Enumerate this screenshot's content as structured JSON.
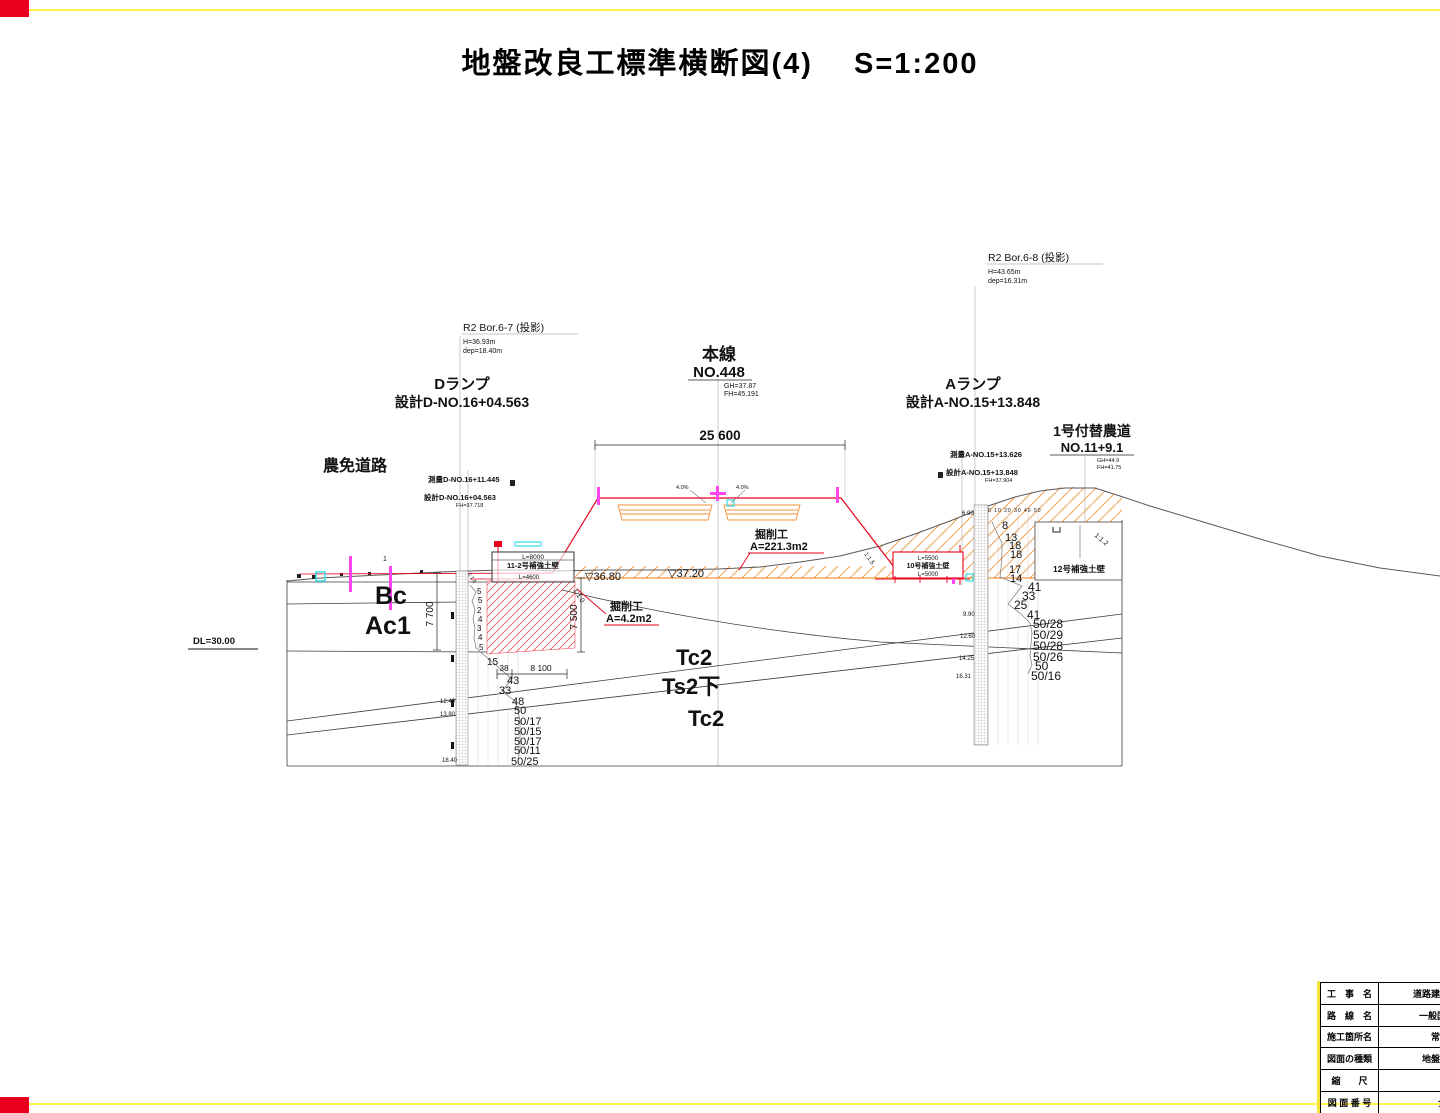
{
  "colors": {
    "frame_yellow": "#fff34d",
    "corner_red": "#e8001e",
    "annotation_red": "#e8001e",
    "hatch_orange": "#f2a359",
    "design_orange": "#f0933a",
    "magenta": "#ff44f0",
    "cyan": "#35dfe6"
  },
  "title": "地盤改良工標準横断図(4)　 S=1:200",
  "datum": "DL=30.00",
  "borings": {
    "b67": {
      "name": "R2 Bor.6-7 (投影)",
      "h": "H=36.93m",
      "dep": "dep=18.40m"
    },
    "b68": {
      "name": "R2 Bor.6-8 (投影)",
      "h": "H=43.65m",
      "dep": "dep=16.31m"
    }
  },
  "axes": {
    "d_ramp": {
      "name": "Dランプ",
      "station": "設計D-NO.16+04.563"
    },
    "main_line": {
      "name": "本線",
      "station": "NO.448",
      "gh": "GH=37.87",
      "fh": "FH=45.191"
    },
    "a_ramp": {
      "name": "Aランプ",
      "station": "設計A-NO.15+13.848"
    },
    "farm_road": {
      "name": "1号付替農道",
      "station": "NO.11+9.1",
      "gh": "GH=44.9",
      "fh": "FH=41.75"
    },
    "nomen": "農免道路",
    "survey_d": "測量D-NO.16+11.445",
    "design_d": "設計D-NO.16+04.563",
    "design_d_fh": "FH=37.718",
    "survey_a": "測量A-NO.15+13.626",
    "design_a": "設計A-NO.15+13.848",
    "design_a_fh": "FH=37.904",
    "pt1": "1"
  },
  "dims": {
    "road_width": "25 600",
    "v_left": "7 700",
    "v_mid": "7 500",
    "w1": "38",
    "w2": "8 100"
  },
  "levels": {
    "l1": "▽36.80",
    "l2": "▽37.20"
  },
  "grades": {
    "left": "4.0%",
    "right": "4.0%"
  },
  "excavation": {
    "big": {
      "t": "掘削工",
      "a": "A=221.3m2"
    },
    "small": {
      "t": "掘削工",
      "a": "A=4.2m2"
    }
  },
  "walls": {
    "w11": {
      "name": "11-2号補強土壁",
      "lt": "L=8000",
      "lb": "L=4600"
    },
    "w10": {
      "name": "10号補強土壁",
      "lt": "L=5500",
      "lb": "L=5000"
    },
    "w12": {
      "name": "12号補強土壁"
    }
  },
  "slopes": {
    "s0": "1:1.0",
    "s1": "1:1.0",
    "s2": "1:1.5",
    "s3": "1:1.2"
  },
  "strata": {
    "bc": "Bc",
    "ac1": "Ac1",
    "tc2a": "Tc2",
    "ts2": "Ts2下",
    "tc2b": "Tc2"
  },
  "spt_left": {
    "vals": [
      "5",
      "5",
      "2",
      "4",
      "3",
      "4",
      "5",
      "15",
      "43",
      "33",
      "48",
      "50",
      "50/17",
      "50/15",
      "50/17",
      "50/11",
      "50/25"
    ],
    "depths": [
      "12.40",
      "13.80",
      "18.40"
    ]
  },
  "spt_right": {
    "scale": "0 10 20 30 40 50",
    "vals": [
      "8",
      "13",
      "18",
      "18",
      "17",
      "14",
      "41",
      "33",
      "25",
      "41",
      "50/28",
      "50/29",
      "50/28",
      "50/26",
      "50",
      "50/16"
    ],
    "depths": [
      "6.90",
      "9.90",
      "12.60",
      "14.25",
      "16.31"
    ]
  },
  "title_block": {
    "rows": [
      {
        "label": "工　事　名",
        "value": "道路建設工事（土"
      },
      {
        "label": "路　線　名",
        "value": "一般国道247号"
      },
      {
        "label": "施工箇所名",
        "value": "常滑市金"
      },
      {
        "label": "図面の種類",
        "value": "地盤改良工標"
      },
      {
        "label": "縮　　尺",
        "value": "S=1"
      },
      {
        "label": "図 面 番 号",
        "value": "全 31"
      }
    ]
  }
}
